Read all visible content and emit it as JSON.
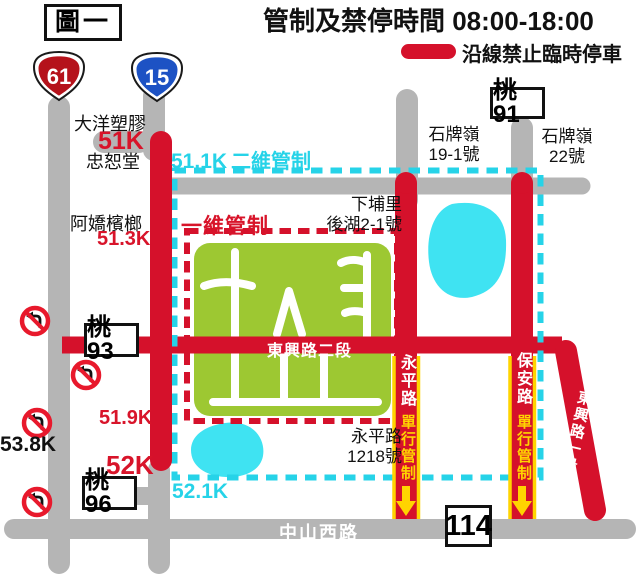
{
  "colors": {
    "road_gray": "#b5b5b5",
    "control_red": "#d5112b",
    "zone_cyan": "#26d3e8",
    "pond_cyan": "#3fe3f2",
    "block_green": "#9dc832",
    "oneway_yellow": "#ffd400"
  },
  "header": {
    "title": "管制及禁停時間 08:00-18:00",
    "figure_label": "圖一",
    "legend_label": "沿線禁止臨時停車"
  },
  "shields": {
    "expressway_61": "61",
    "highway_15": "15"
  },
  "route_boxes": {
    "tao91": "桃91",
    "tao93": "桃93",
    "tao96": "桃96",
    "r114": "114"
  },
  "zones": {
    "two_dim_control": "二維管制",
    "one_dim_control": "一維管制",
    "oneway_control": "單行管制"
  },
  "mileposts": {
    "k51": "51K",
    "k51_1": "51.1K",
    "k51_3": "51.3K",
    "k51_9": "51.9K",
    "k52": "52K",
    "k52_1": "52.1K",
    "k53_8": "53.8K"
  },
  "places": {
    "dayang": "大洋塑膠",
    "zhongshu": "忠恕堂",
    "ajiao": "阿嬌檳榔",
    "shipai_19": {
      "l1": "石牌嶺",
      "l2": "19-1號"
    },
    "shipai_22": {
      "l1": "石牌嶺",
      "l2": "22號"
    },
    "xiapu": {
      "l1": "下埔里",
      "l2": "後湖2-1號"
    },
    "yongping_1218": {
      "l1": "永平路",
      "l2": "1218號"
    }
  },
  "roads": {
    "dongxing_sec2": "東興路二段",
    "dongxing_sec1": "東興路一段",
    "yongping": "永平路",
    "baoan": "保安路",
    "zhongshan_w": "中山西路"
  }
}
